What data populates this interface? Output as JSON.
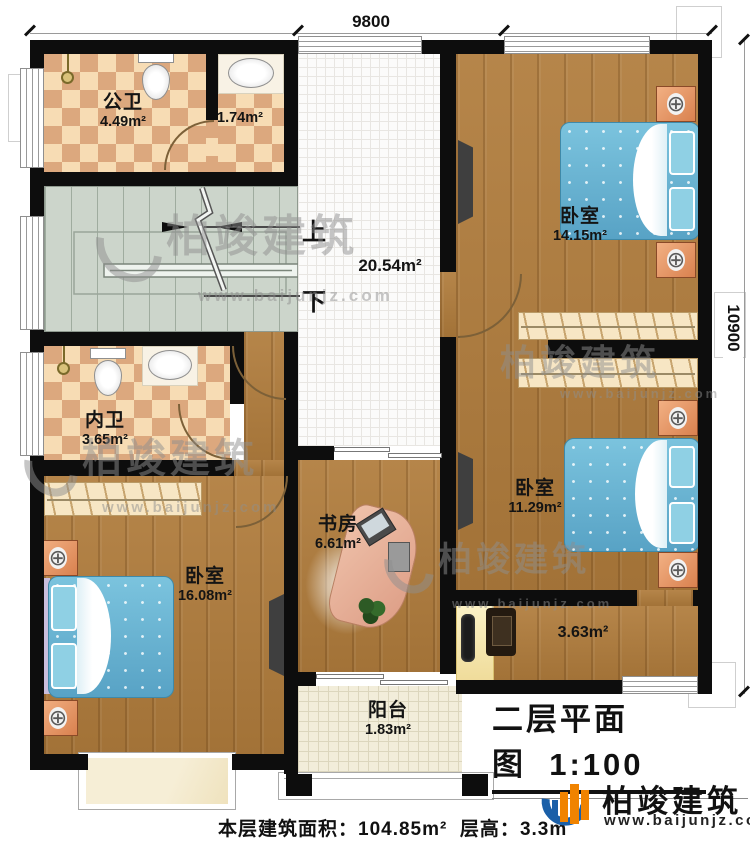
{
  "dimensions": {
    "top": "9800",
    "right": "10900"
  },
  "stair_labels": {
    "up": "上",
    "down": "下"
  },
  "rooms": {
    "public_bath": {
      "name": "公卫",
      "area": "4.49m²"
    },
    "wash": {
      "area": "1.74m²"
    },
    "hall": {
      "area": "20.54m²"
    },
    "bedroom_top": {
      "name": "卧室",
      "area": "14.15m²"
    },
    "private_bath": {
      "name": "内卫",
      "area": "3.65m²"
    },
    "bedroom_right": {
      "name": "卧室",
      "area": "11.29m²"
    },
    "study": {
      "name": "书房",
      "area": "6.61m²"
    },
    "bedroom_left": {
      "name": "卧室",
      "area": "16.08m²"
    },
    "dress_corridor": {
      "area": "3.63m²"
    },
    "balcony": {
      "name": "阳台",
      "area": "1.83m²"
    }
  },
  "title": {
    "name": "二层平面图",
    "scale": "1:100"
  },
  "footer": {
    "area_label": "本层建筑面积：",
    "area_value": "104.85m²",
    "height_label": "层高：",
    "height_value": "3.3m"
  },
  "brand": {
    "name": "柏竣建筑",
    "site": "www.baijunjz.com"
  },
  "icons": {
    "lamp": "⊕"
  },
  "colors": {
    "wall": "#0d0d0d",
    "wood": "#b07c3c",
    "tile_light": "#f7dcb4",
    "tile_dark": "#dca87e",
    "bed": "#64b9d8",
    "nightstand": "#e9965c",
    "brand_blue": "#1a5fa8",
    "brand_orange": "#f08300"
  }
}
